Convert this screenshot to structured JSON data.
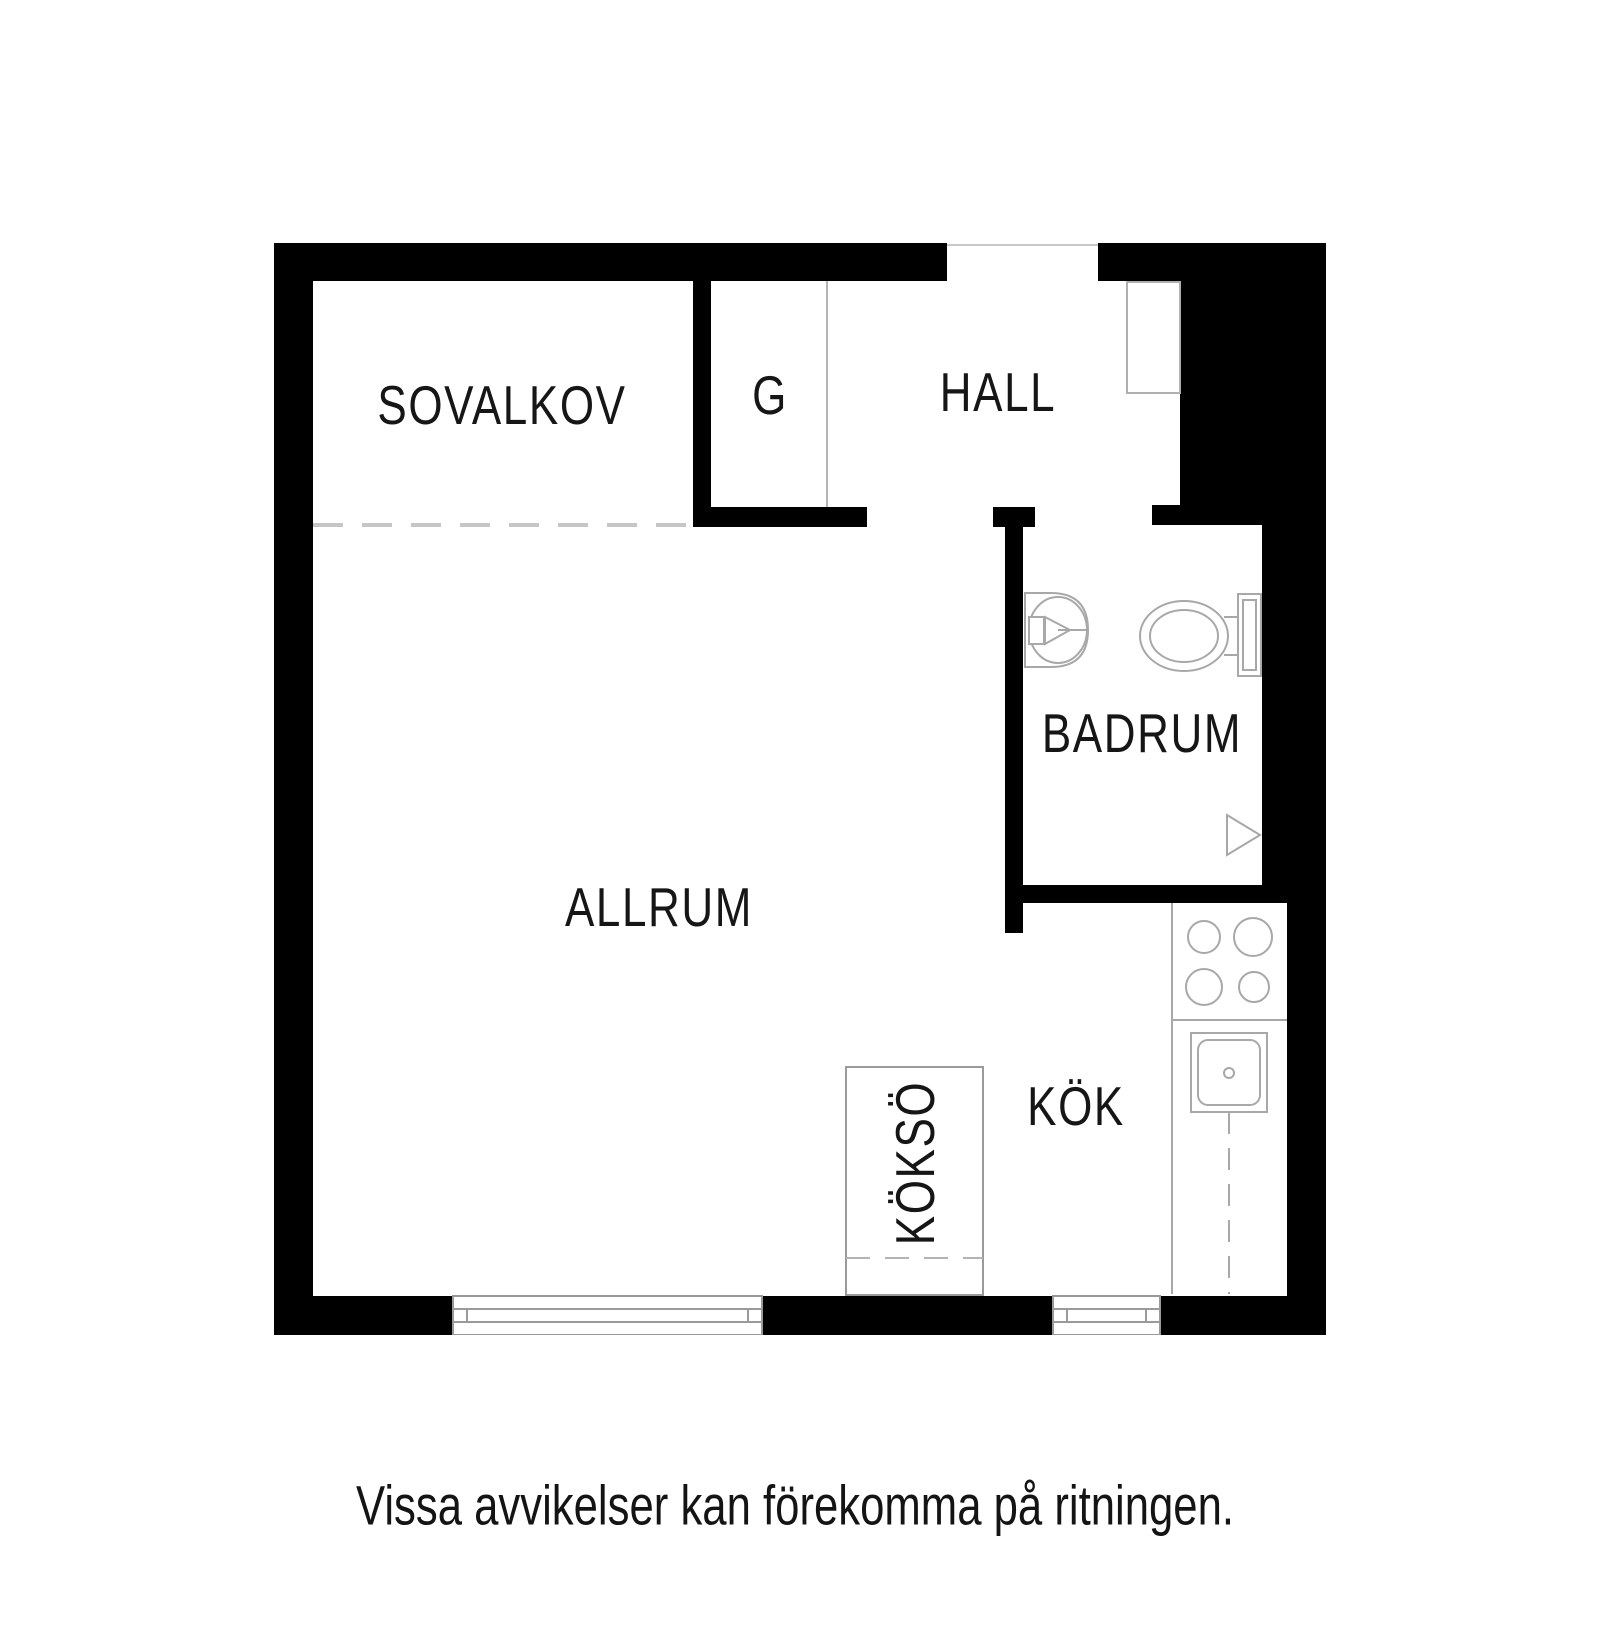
{
  "page": {
    "caption": "Vissa avvikelser kan förekomma på ritningen."
  },
  "colors": {
    "wall": "#000000",
    "fixture_line": "#a8a8a8",
    "light_line": "#c6c6c6",
    "text": "#161616"
  },
  "rooms": [
    {
      "id": "sovalkov",
      "label": "SOVALKOV"
    },
    {
      "id": "g",
      "label": "G"
    },
    {
      "id": "hall",
      "label": "HALL"
    },
    {
      "id": "badrum",
      "label": "BADRUM"
    },
    {
      "id": "allrum",
      "label": "ALLRUM"
    },
    {
      "id": "kok",
      "label": "KÖK"
    },
    {
      "id": "kokso",
      "label": "KÖKSÖ"
    }
  ],
  "fixtures": [
    "entry-door",
    "wardrobe-front",
    "washbasin",
    "toilet",
    "shower-symbol",
    "stove-burners",
    "kitchen-sink",
    "kitchen-counter",
    "kitchen-island",
    "window",
    "window",
    "sleeping-alcove-dashed-boundary"
  ]
}
